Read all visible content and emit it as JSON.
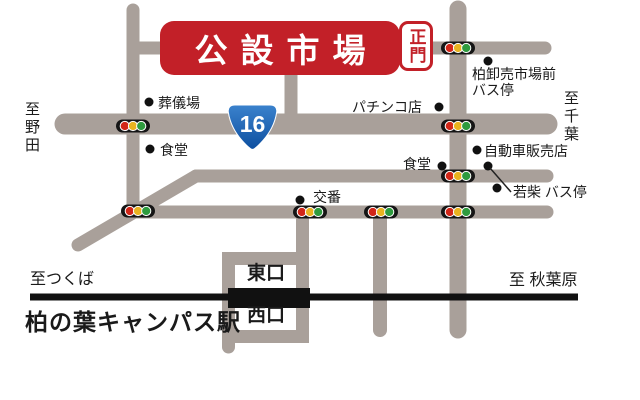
{
  "map": {
    "title_banner": {
      "label": "公設市場",
      "gate_label": "正門"
    },
    "route_shield": {
      "number": "16"
    },
    "direction_labels": {
      "west_vertical": "至野田",
      "east_vertical": "至千葉",
      "rail_left": "至つくば",
      "rail_right": "至 秋葉原"
    },
    "pois": {
      "funeral_hall": "葬儀場",
      "dining_left": "食堂",
      "pachinko": "パチンコ店",
      "wholesale_market_bus_stop_line1": "柏卸売市場前",
      "wholesale_market_bus_stop_line2": "バス停",
      "car_dealer": "自動車販売店",
      "dining_right": "食堂",
      "police_box": "交番",
      "wakashiba_bus_stop": "若柴 バス停"
    },
    "station": {
      "name": "柏の葉キャンパス駅",
      "east_exit": "東口",
      "west_exit": "西口"
    },
    "colors": {
      "road": "#a9a09a",
      "railway": "#111111",
      "banner_red": "#c22028",
      "shield_blue_top": "#3b82cd",
      "shield_blue_bottom": "#0d4fa0",
      "dot": "#111111",
      "signal_red": "#d22618",
      "signal_yellow": "#e9b320",
      "signal_green": "#2e9b3e"
    }
  }
}
